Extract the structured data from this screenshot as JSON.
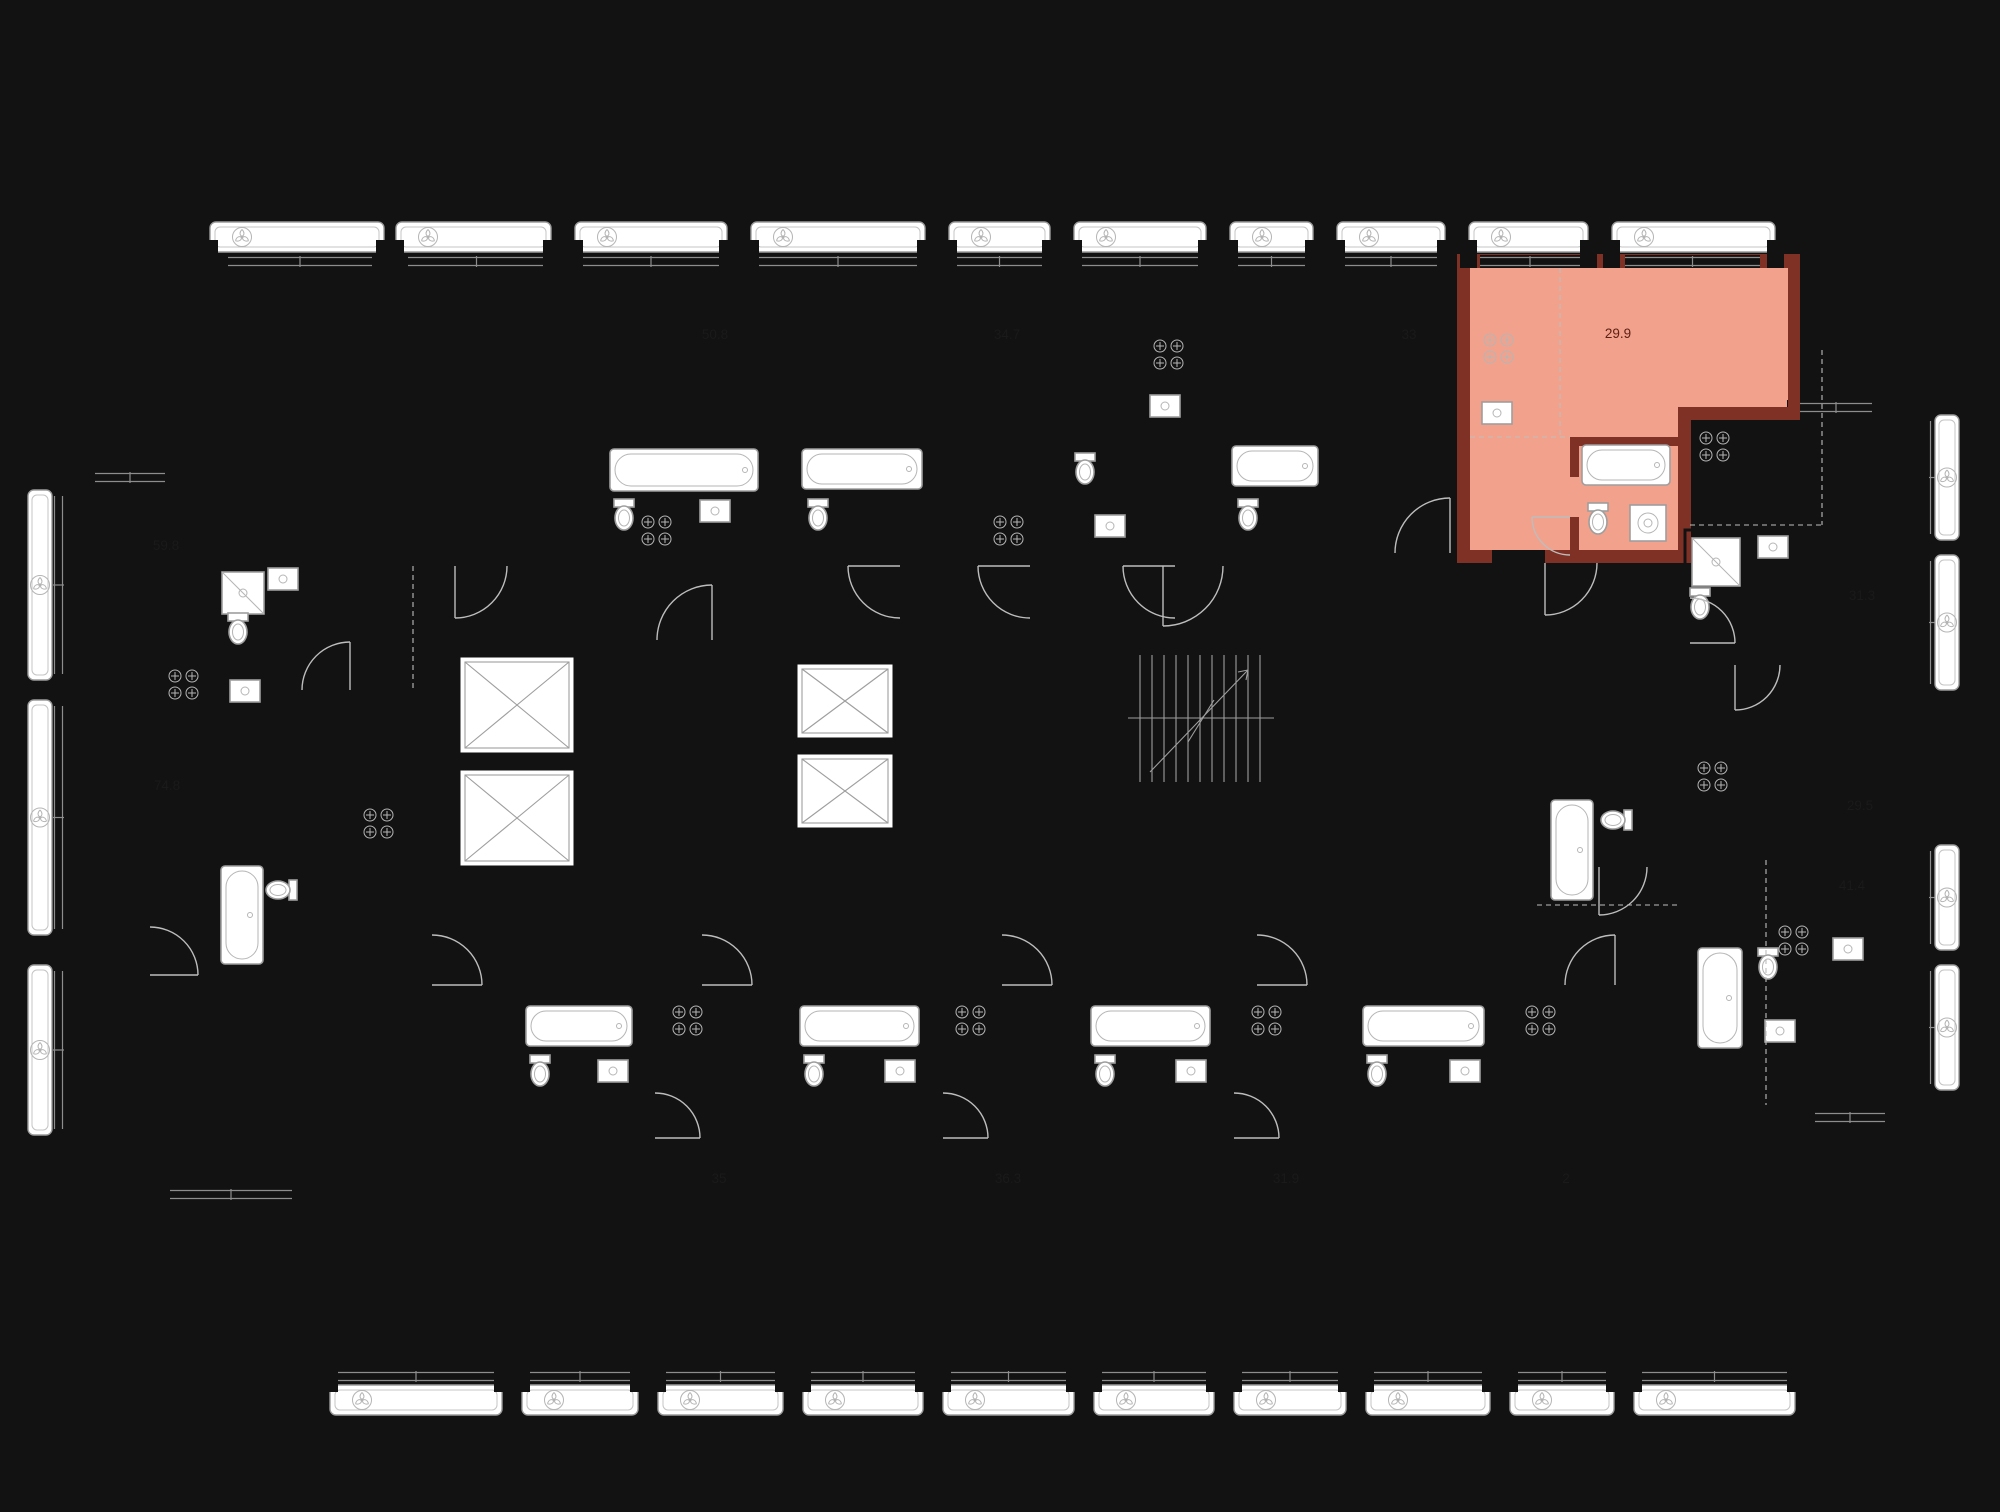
{
  "floor_plan": {
    "type": "residential-floor-plan",
    "highlighted_apartment": {
      "area_label": "29.9",
      "fill_color": "#f2a28c",
      "wall_color": "#7e3124",
      "label_color": "#5e2012"
    },
    "colors": {
      "background": "#ffffff",
      "walls": "#121212",
      "fixtures": "#9e9e9e"
    },
    "rooms": [
      {
        "label": "50.8",
        "x": 715,
        "y": 339,
        "highlighted": false
      },
      {
        "label": "34.7",
        "x": 1007,
        "y": 339,
        "highlighted": false
      },
      {
        "label": "33",
        "x": 1409,
        "y": 339,
        "highlighted": false
      },
      {
        "label": "29.9",
        "x": 1618,
        "y": 338,
        "highlighted": true
      },
      {
        "label": "59.8",
        "x": 166,
        "y": 550,
        "highlighted": false
      },
      {
        "label": "74.8",
        "x": 167,
        "y": 790,
        "highlighted": false
      },
      {
        "label": "31.3",
        "x": 1862,
        "y": 600,
        "highlighted": false
      },
      {
        "label": "29.5",
        "x": 1860,
        "y": 810,
        "highlighted": false
      },
      {
        "label": "41.4",
        "x": 1852,
        "y": 890,
        "highlighted": false
      },
      {
        "label": "35",
        "x": 719,
        "y": 1183,
        "highlighted": false
      },
      {
        "label": "36.3",
        "x": 1008,
        "y": 1183,
        "highlighted": false
      },
      {
        "label": "31.9",
        "x": 1286,
        "y": 1183,
        "highlighted": false
      },
      {
        "label": "2",
        "x": 1566,
        "y": 1183,
        "highlighted": false
      }
    ],
    "icons": [
      "ventilation-fan-icon",
      "elevator-icon",
      "stairs-icon",
      "bathtub-icon",
      "toilet-icon",
      "sink-icon",
      "shower-icon",
      "washer-icon",
      "stove-icon"
    ]
  }
}
